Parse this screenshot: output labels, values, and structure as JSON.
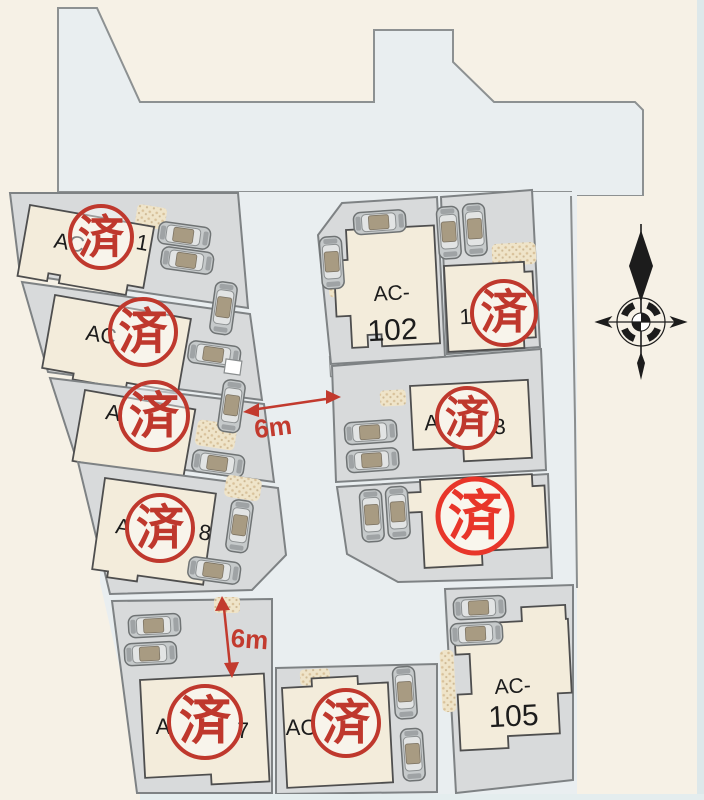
{
  "plan": {
    "type": "residential-lot-site-plan",
    "stamp_label": "済",
    "dimensions": {
      "center_road": "6m",
      "south_road": "6m"
    },
    "colors": {
      "background": "#f6f1e6",
      "road": "#e9eef0",
      "parcel": "#d8dadb",
      "building": "#f3ecdb",
      "stamp_red": "#bf382d",
      "stamp_bright_red": "#e8362a",
      "annotation_red": "#c23a2e"
    },
    "lots": {
      "nw1": {
        "left": "AC",
        "right": "1",
        "sold": true
      },
      "nw2": {
        "left": "AC",
        "right": "",
        "sold": true
      },
      "nw3": {
        "left": "A",
        "right": "",
        "sold": true
      },
      "nw4": {
        "left": "A",
        "right": "8",
        "sold": true
      },
      "sw1": {
        "left": "A",
        "right": "7",
        "sold": true
      },
      "s2": {
        "left": "AC",
        "right": "",
        "sold": true
      },
      "c102": {
        "line1": "AC-",
        "line2": "102",
        "sold": false
      },
      "ne1": {
        "left": "1",
        "right": "",
        "sold": true
      },
      "e3": {
        "left": "A",
        "right": "3",
        "sold": true
      },
      "e4": {
        "left": "",
        "right": "",
        "sold": true
      },
      "se105": {
        "line1": "AC-",
        "line2": "105",
        "sold": false
      }
    }
  }
}
